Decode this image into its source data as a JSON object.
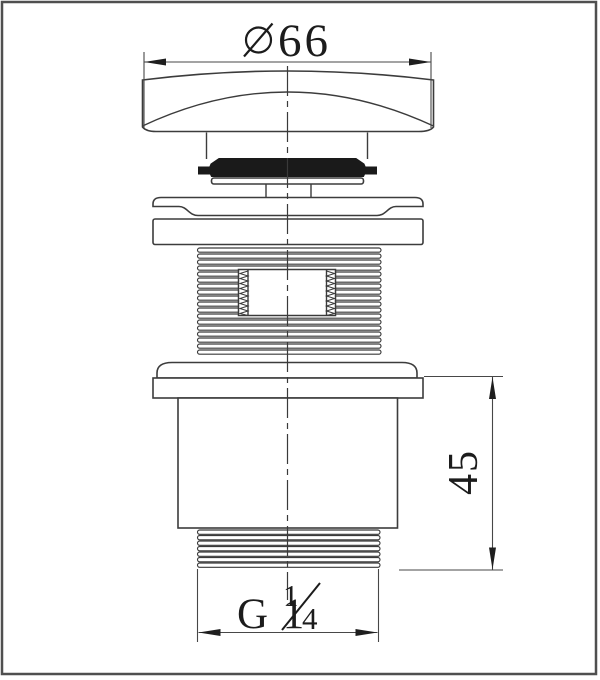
{
  "page": {
    "background": "#ffffff",
    "frame_color": "#4f4f4f"
  },
  "drawing": {
    "kind": "technical-line-drawing",
    "subject": "pop-up basin waste plug, side elevation",
    "line_color": "#3c3c3c",
    "dimensions": {
      "top_diameter": {
        "symbol": "∅",
        "value": "66",
        "label": "∅ 66",
        "orientation": "horizontal"
      },
      "right_height": {
        "value": "45",
        "label": "45",
        "orientation": "vertical"
      },
      "bottom_thread": {
        "prefix": "G 1",
        "fraction_numerator": "1",
        "fraction_denominator": "4",
        "label": "G 1¼",
        "orientation": "horizontal"
      }
    }
  }
}
